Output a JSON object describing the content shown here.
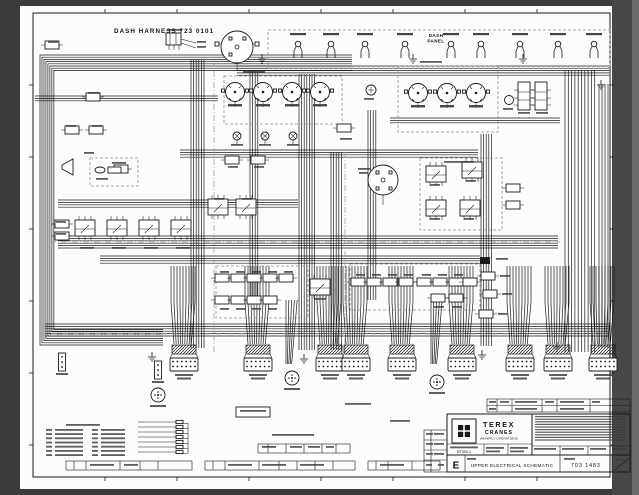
{
  "sheet": {
    "harness_title": "DASH HARNESS 723 0101",
    "dash_panel": {
      "line1": "DASH",
      "line2": "PANEL"
    }
  },
  "title_block": {
    "company": "TEREX",
    "division": "CRANES",
    "operations": "WAVERLY OPERATIONS",
    "model": "RT300-1",
    "drawing_title": "UPPER ELECTRICAL SCHEMATIC",
    "drawing_number": "703 1483",
    "revision": "E"
  },
  "colors": {
    "outer_matte": "#3b3b3b",
    "paper": "#fcfcfa",
    "ink": "#1a1a1a",
    "group_outline_gray": "#8f8f8f"
  }
}
